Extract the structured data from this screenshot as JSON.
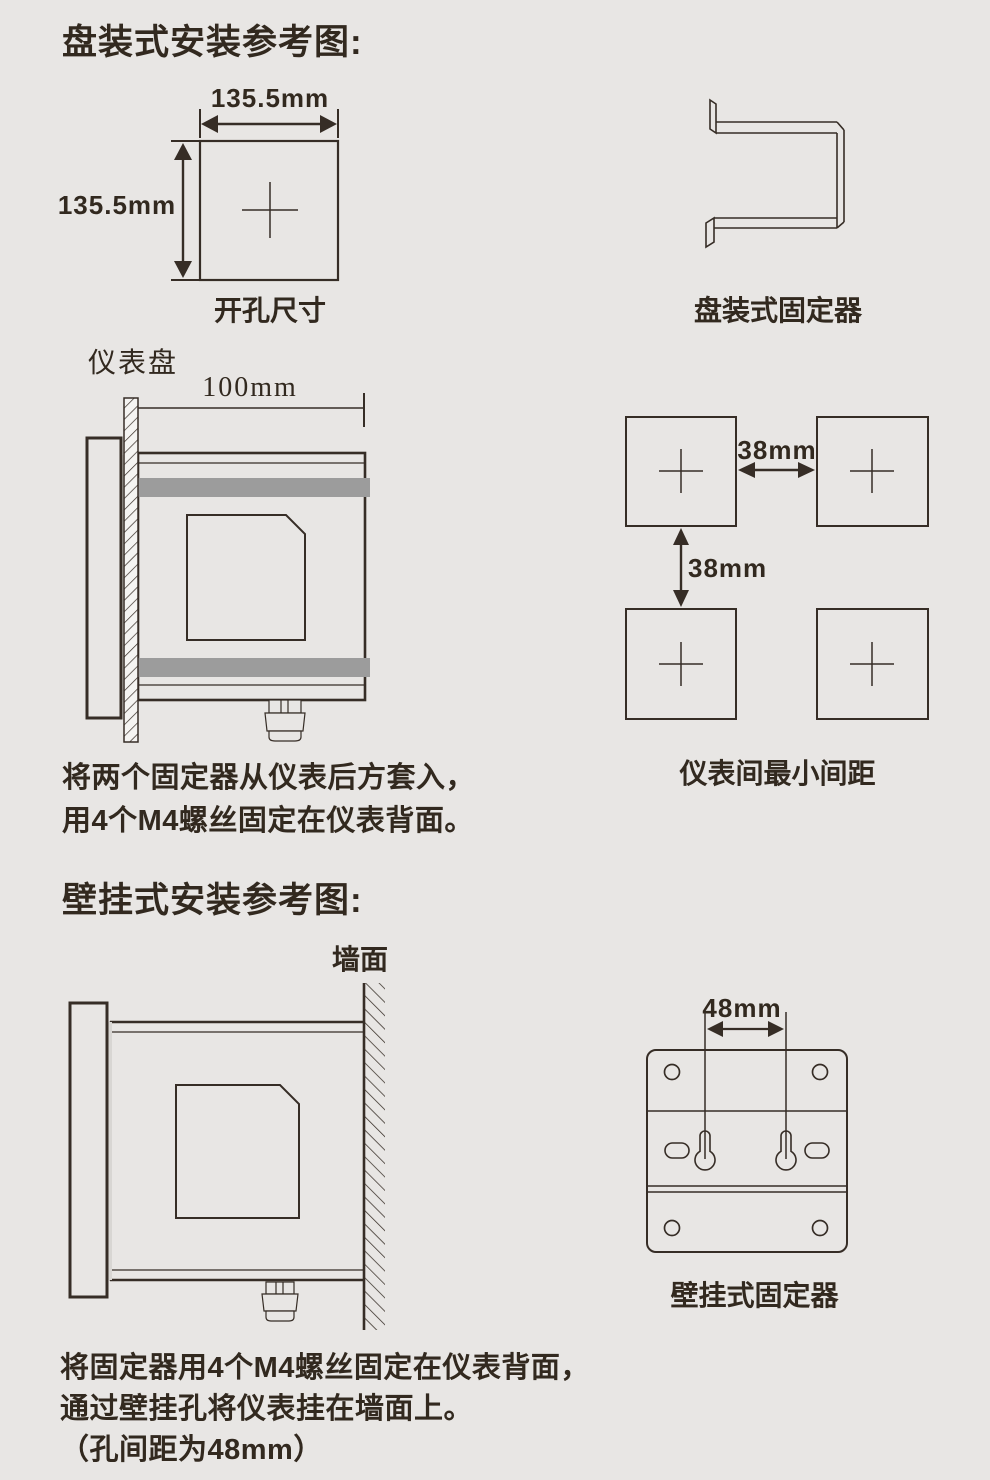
{
  "page": {
    "bg_color": "#e8e6e4",
    "line_color": "#362d26",
    "text_color": "#32291f",
    "band_color": "#9c9c9c"
  },
  "panel_mount": {
    "title": "盘装式安装参考图:",
    "cutout_width": "135.5mm",
    "cutout_height": "135.5mm",
    "cutout_caption": "开孔尺寸",
    "bracket_caption": "盘装式固定器",
    "panel_label": "仪表盘",
    "depth_dim": "100mm",
    "h_gap_dim": "38mm",
    "v_gap_dim": "38mm",
    "spacing_caption": "仪表间最小间距",
    "note_line1": "将两个固定器从仪表后方套入，",
    "note_line2": "用4个M4螺丝固定在仪表背面。"
  },
  "wall_mount": {
    "title": "壁挂式安装参考图:",
    "wall_label": "墙面",
    "hole_spacing_dim": "48mm",
    "fixer_caption": "壁挂式固定器",
    "note_line1": "将固定器用4个M4螺丝固定在仪表背面，",
    "note_line2": "通过壁挂孔将仪表挂在墙面上。",
    "note_line3": "（孔间距为48mm）"
  }
}
